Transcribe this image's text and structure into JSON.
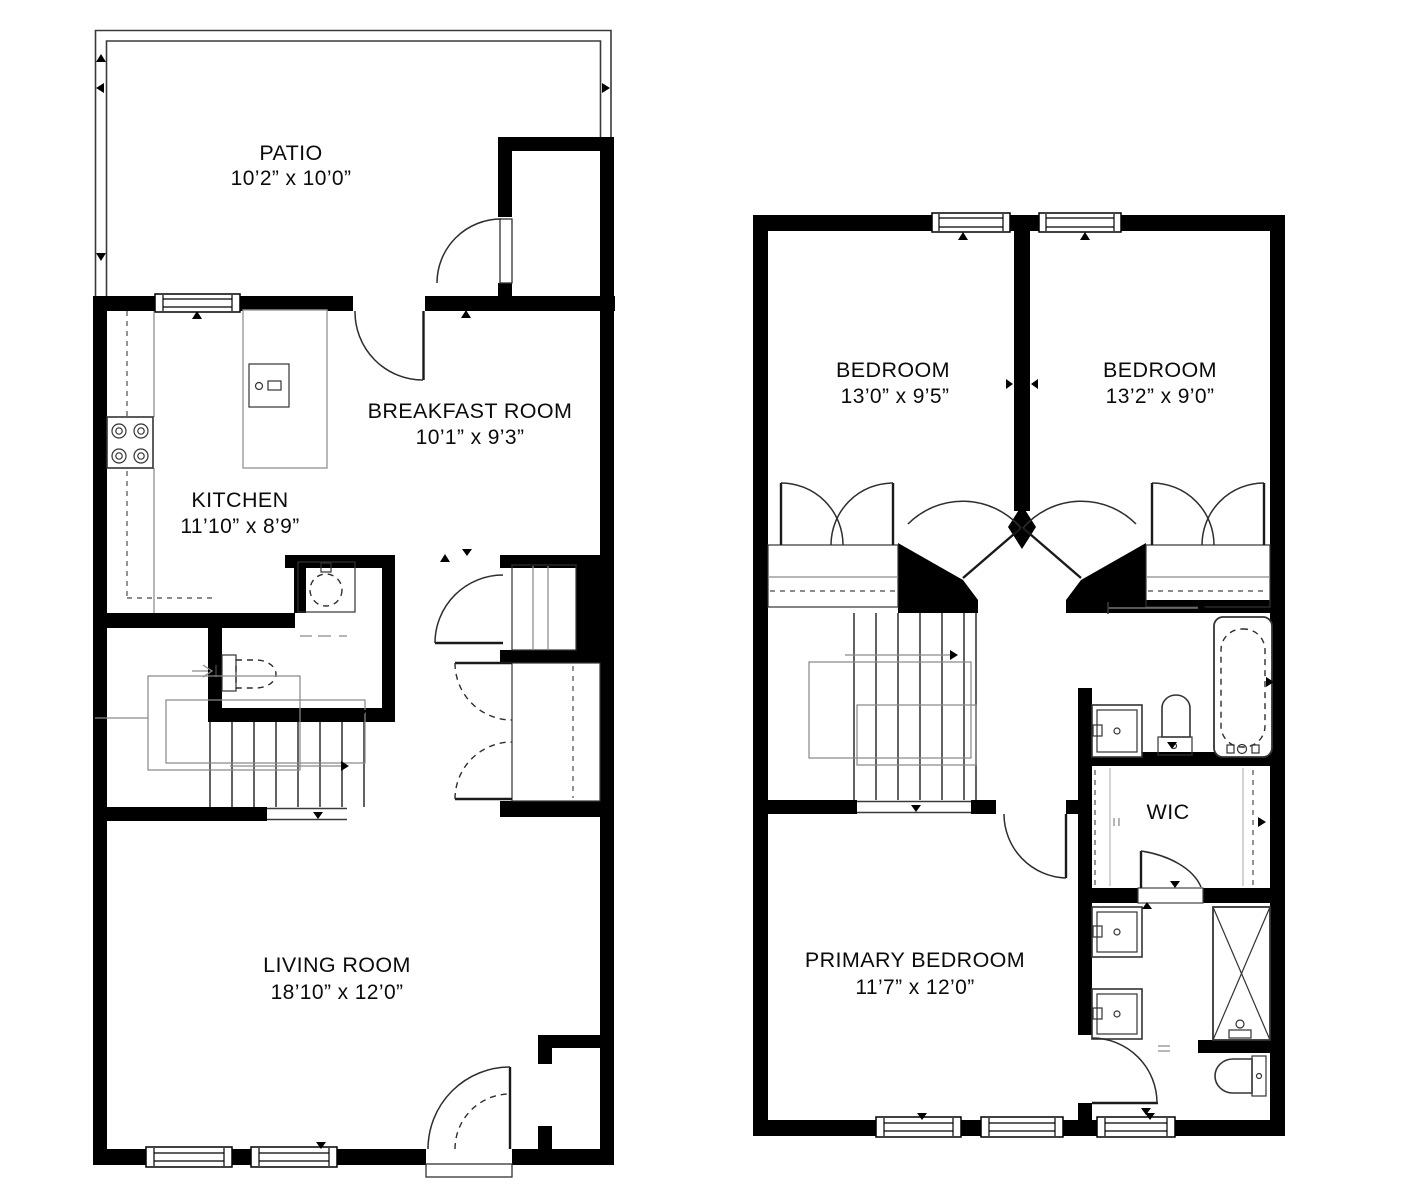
{
  "colors": {
    "walls": "#000000",
    "background": "#ffffff",
    "fixture_lines": "#3a3a3a"
  },
  "floors": [
    {
      "name": "first-floor",
      "rooms": [
        {
          "id": "patio",
          "label": "PATIO",
          "dims": "10’2” x 10’0”"
        },
        {
          "id": "breakfast-room",
          "label": "BREAKFAST ROOM",
          "dims": "10’1” x 9’3”"
        },
        {
          "id": "kitchen",
          "label": "KITCHEN",
          "dims": "11’10” x 8’9”"
        },
        {
          "id": "living-room",
          "label": "LIVING ROOM",
          "dims": "18’10” x 12’0”"
        }
      ]
    },
    {
      "name": "second-floor",
      "rooms": [
        {
          "id": "bedroom-left",
          "label": "BEDROOM",
          "dims": "13’0” x 9’5”"
        },
        {
          "id": "bedroom-right",
          "label": "BEDROOM",
          "dims": "13’2” x 9’0”"
        },
        {
          "id": "wic",
          "label": "WIC",
          "dims": ""
        },
        {
          "id": "primary-bedroom",
          "label": "PRIMARY BEDROOM",
          "dims": "11’7” x 12’0”"
        }
      ]
    }
  ]
}
